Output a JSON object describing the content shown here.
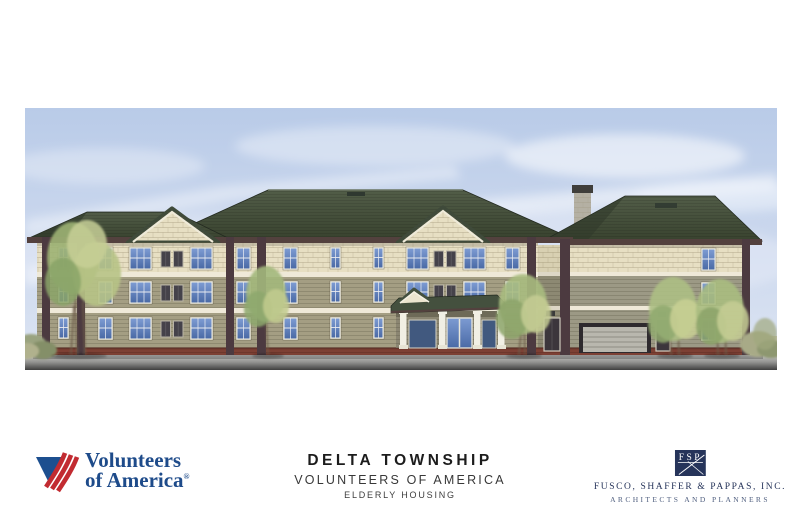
{
  "board": {
    "title": "DELTA TOWNSHIP",
    "subtitle": "VOLUNTEERS OF AMERICA",
    "project_type": "ELDERLY HOUSING"
  },
  "voa_logo": {
    "line1": "Volunteers",
    "line2": "of America",
    "registered": "®"
  },
  "architect": {
    "monogram": "FSP",
    "firm": "FUSCO, SHAFFER & PAPPAS, INC.",
    "tagline": "ARCHITECTS AND PLANNERS"
  },
  "colors": {
    "sky": "#c8d5ec",
    "roof_green": "#45503f",
    "shingle_cream": "#e7dfc3",
    "clapboard_olive": "#a49e83",
    "clapboard_gray": "#9c9985",
    "trim_maroon": "#4c3a40",
    "brick_red": "#7d4034",
    "window_blue": "#5b82c0",
    "voa_blue": "#1e4b8a",
    "voa_red": "#c22b31",
    "navy": "#26345a"
  }
}
